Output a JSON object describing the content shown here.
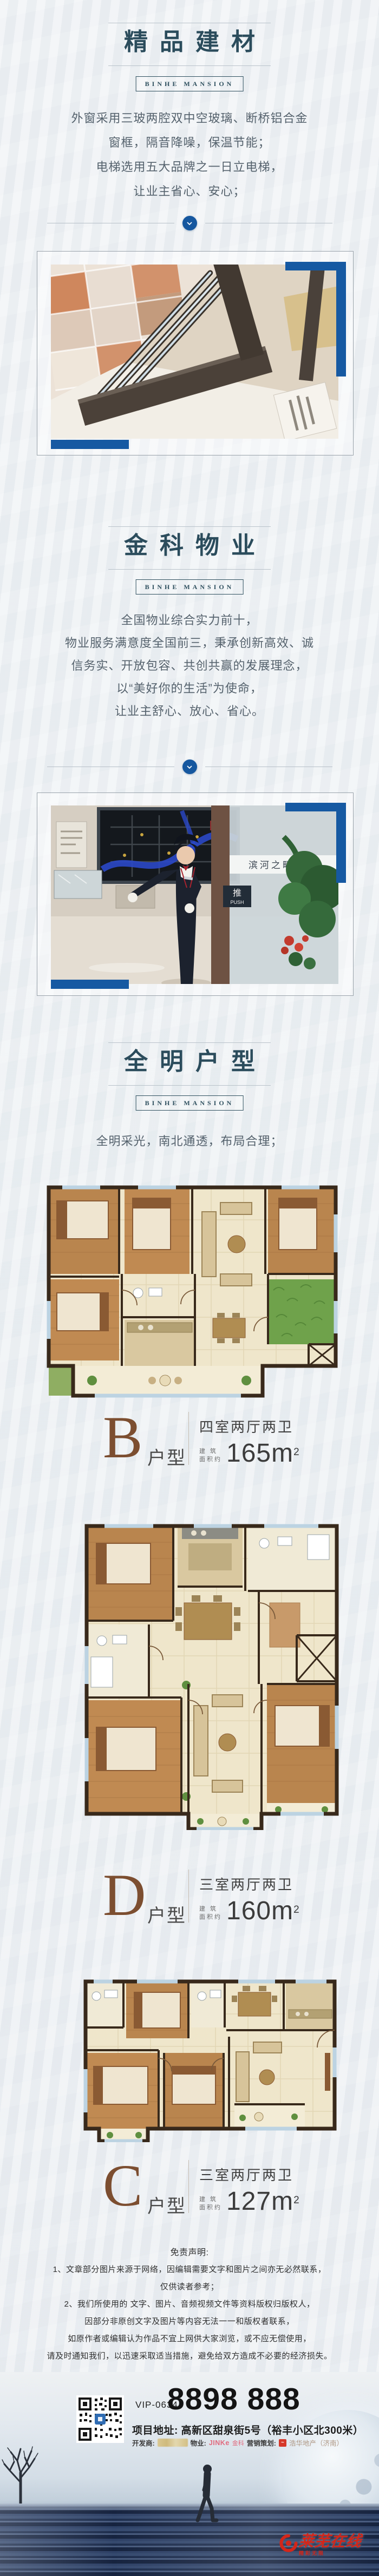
{
  "brand_box": "BINHE MANSION",
  "sections": {
    "materials": {
      "title": "精品建材",
      "lines": [
        "外窗采用三玻两腔双中空玻璃、断桥铝合金",
        "窗框，隔音降噪，保温节能；",
        "电梯选用五大品牌之一日立电梯，",
        "让业主省心、安心；"
      ]
    },
    "property": {
      "title": "金科物业",
      "lines": [
        "全国物业综合实力前十，",
        "物业服务满意度全国前三，秉承创新高效、诚",
        "信务实、开放包容、共创共赢的发展理念，",
        "以“美好你的生活”为使命，",
        "让业主舒心、放心、省心。"
      ]
    },
    "floorplan": {
      "title": "全明户型",
      "lines": [
        "全明采光，南北通透，布局合理；"
      ]
    }
  },
  "photos": {
    "office": {
      "glass_text": "滨河之畔 学府",
      "door_sign_cn": "推",
      "door_sign_en": "PUSH",
      "map_badge": "本案",
      "map_area_text": "新区"
    }
  },
  "plans": [
    {
      "letter": "B",
      "type_suffix": "户型",
      "rooms": "四室两厅两卫",
      "area_prefix_1": "建 筑",
      "area_prefix_2": "面积约",
      "area_value": "165m",
      "area_sup": "2"
    },
    {
      "letter": "D",
      "type_suffix": "户型",
      "rooms": "三室两厅两卫",
      "area_prefix_1": "建 筑",
      "area_prefix_2": "面积约",
      "area_value": "160m",
      "area_sup": "2"
    },
    {
      "letter": "C",
      "type_suffix": "户型",
      "rooms": "三室两厅两卫",
      "area_prefix_1": "建 筑",
      "area_prefix_2": "面积约",
      "area_value": "127m",
      "area_sup": "2"
    }
  ],
  "disclaimer": {
    "title": "免责声明:",
    "lines": [
      "1、文章部分图片来源于网络，因编辑需要文字和图片之间亦无必然联系，",
      "仅供读者参考；",
      "2、我们所使用的 文字、图片、音频视频文件等资料版权归版权人，",
      "因部分非原创文字及图片等内容无法一一和版权者联系，",
      "如原作者或编辑认为作品不宜上网供大家浏览，或不应无偿使用，",
      "请及时通知我们，以迅速采取适当措施，避免给双方造成不必要的经济损失。"
    ]
  },
  "footer": {
    "vip": "VIP-0634",
    "phone": "8898 888",
    "address": "项目地址: 高新区甜泉街5号（裕丰小区北300米）",
    "developer_label": "开发商:",
    "property_label": "物业:",
    "property_brand": "JINKe",
    "property_brand_suffix": "金科",
    "marketing_label": "营销策划:",
    "marketing_brand": "浩华地产（济南）",
    "watermark_main": "莱芜在线",
    "watermark_sub": "精彩无限"
  },
  "colors": {
    "accent_blue": "#1659a2",
    "title_ink": "#2b4c5c",
    "plan_letter_brown": "#7c4e30",
    "watermark_red": "#d3261a"
  }
}
